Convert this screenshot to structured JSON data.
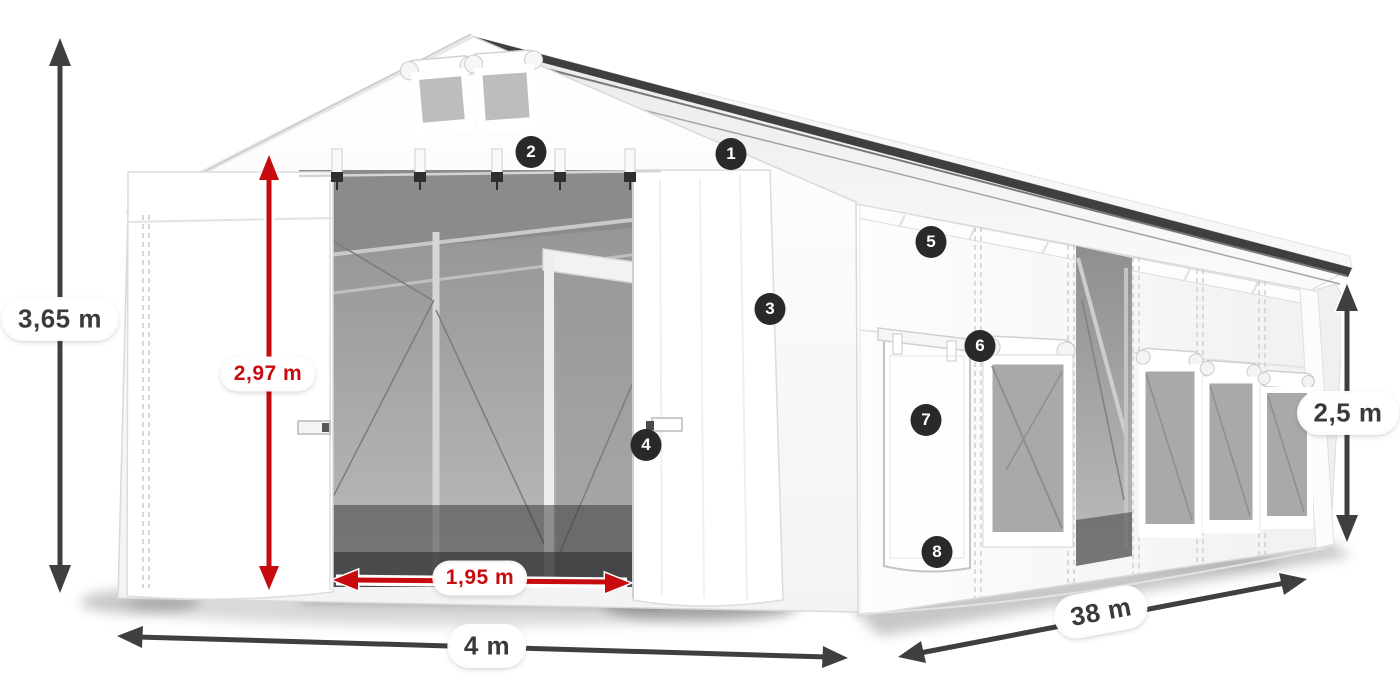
{
  "diagram": {
    "type": "tent-dimensions-illustration",
    "dimensions": {
      "total_height": {
        "label": "3,65 m",
        "style": "dark"
      },
      "entrance_height": {
        "label": "2,97 m",
        "style": "red"
      },
      "entrance_width": {
        "label": "1,95 m",
        "style": "red"
      },
      "width": {
        "label": "4 m",
        "style": "dark"
      },
      "length": {
        "label": "38 m",
        "style": "dark"
      },
      "side_height": {
        "label": "2,5 m",
        "style": "dark"
      }
    },
    "callouts": {
      "c1": "1",
      "c2": "2",
      "c3": "3",
      "c4": "4",
      "c5": "5",
      "c6": "6",
      "c7": "7",
      "c8": "8"
    },
    "colors": {
      "dimension_dark": "#3f3f41",
      "dimension_red": "#c70b0e",
      "badge_background": "#29292b",
      "badge_number": "#ffffff",
      "tent_white": "#ffffff",
      "interior_gray": "#9c9c9c"
    }
  }
}
